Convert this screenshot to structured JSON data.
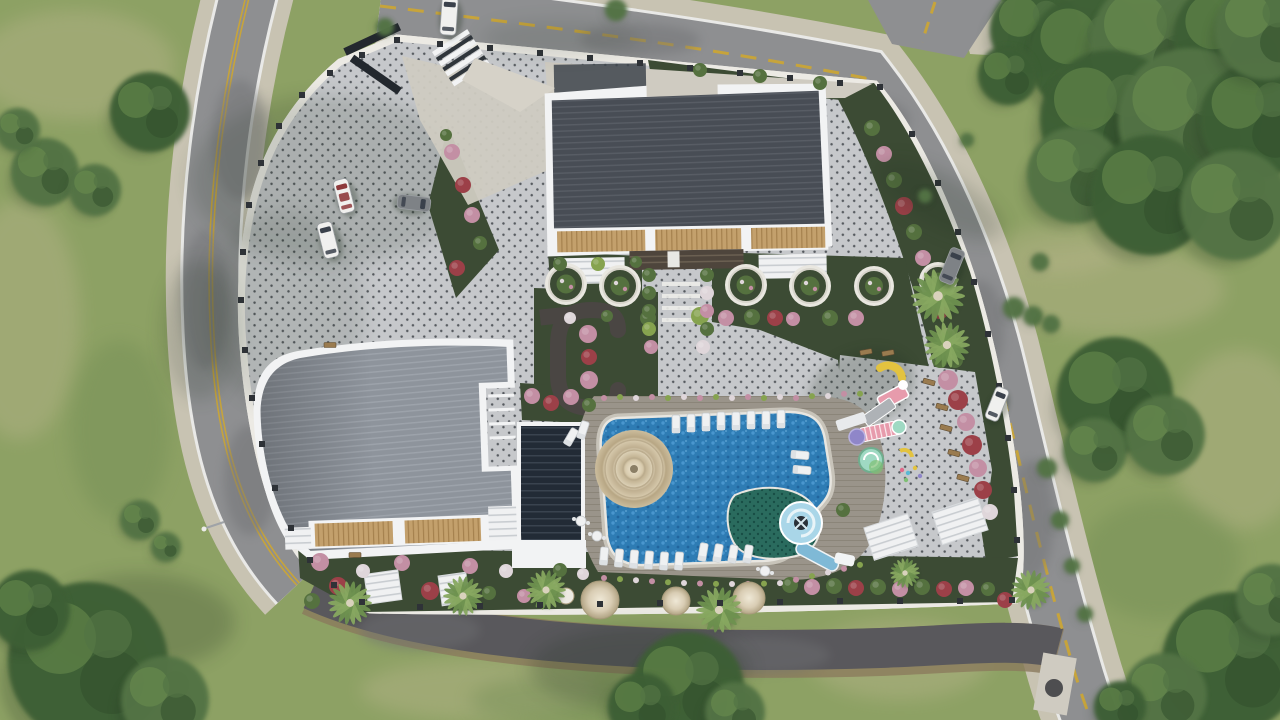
{
  "meta": {
    "type": "aerial-3d-architectural-render",
    "subject": "top-down site plan of a residential complex with two apartment blocks, pool and gardens",
    "view": "bird's-eye / plan view",
    "dimensions": "1280x720"
  },
  "palette": {
    "grass_base": "#8DA164",
    "grass_light": "#B6B489",
    "grass_dark": "#708B52",
    "tree_dark": "#3E5F35",
    "tree_mid": "#527345",
    "tree_light": "#6E914F",
    "road": "#8E8F91",
    "road_dark": "#59585C",
    "road_brown": "#8B7B5C",
    "road_edge": "#E9E9E7",
    "road_yellow": "#C7A43B",
    "sidewalk": "#C8C3B2",
    "curb": "#ECEAE4",
    "paving": "#C6C8CB",
    "paving_dot": "#42464C",
    "fence": "#2E3237",
    "roof_a": "#484D55",
    "roof_a_rib": "#585D65",
    "roof_b": "#8E949C",
    "roof_b_rib": "#9DA3AB",
    "trim": "#F2F3F4",
    "wood": "#C3A06C",
    "wood_rib": "#A5814E",
    "garden": "#3C4B34",
    "bush_green": "#55713F",
    "bush_lime": "#86A34F",
    "flower_pink": "#C38FA4",
    "flower_red": "#9C4048",
    "flower_white": "#DFD6DA",
    "deck": "#9A948A",
    "deck_rib": "#8B8579",
    "pool": "#2E7CB4",
    "pool_light": "#4E9BD2",
    "pool_deep": "#1F639B",
    "kids_pool": "#2A6B5E",
    "kids_dot": "#184E45",
    "slide": "#A9D6E8",
    "slide_deep": "#7FB9D6",
    "cone": "#D8CBB0",
    "cone_ring": "#BCAD8F",
    "dome": "#D9CDB4",
    "pergola_dark": "#222B36",
    "pergola_rib": "#39434F",
    "canopy": "#F0F1F2",
    "canopy_rib": "#C9CDD1",
    "path_dark": "#4A4643",
    "steps_brown": "#4E453C",
    "concrete": "#CFCBC1",
    "car_white": "#F0F0EE",
    "car_gray": "#7E8286",
    "car_red": "#8E3A3C",
    "glass": "#3A414B",
    "shadow": "#223022",
    "play_yellow": "#E3C33F",
    "play_pink": "#E79BAC",
    "play_mint": "#9FD9C3",
    "play_green": "#7FBF74",
    "play_purple": "#8F86C9",
    "play_gray": "#AEB2B6"
  },
  "scene": {
    "site": {
      "boundary": "fenced polygon bounded by curving asphalt roads on all sides",
      "paving": "light pavers with dark diamond dot grid",
      "entrance": "north gate with white stairs and ramp"
    },
    "buildings": [
      {
        "id": "block-a",
        "position": "top-center",
        "roof": "dark gray ribbed",
        "trim": "white",
        "balconies": "wood-slat"
      },
      {
        "id": "block-b",
        "position": "center-left",
        "roof": "light gray ribbed with curved corner",
        "trim": "white",
        "balconies": "wood-slat"
      }
    ],
    "amenities": {
      "pool": "free-form blue swimming pool with coping",
      "kids_pool": "dark teal tiled splash pool",
      "water_slide": "light blue spiral slide",
      "shade_cone": "beige conical canopy over pool corner",
      "sun_loungers": 22,
      "round_tables": 3,
      "playground": "colorful play structures on paved court",
      "white_pergolas": 4,
      "dark_pergola": 1,
      "garden_domes": 5,
      "circular_planters": 6,
      "walking_loop": "dark C-shaped garden path"
    },
    "vehicles": {
      "parking_lot": [
        "white convertible",
        "white van",
        "gray sedan"
      ],
      "street": [
        "white van at north gate",
        "gray car on east road",
        "white car on east road"
      ]
    },
    "vegetation": {
      "palm_trees": 8,
      "tree_clusters": "dense green canopies on surrounding lawn",
      "shrubs": "rows of green, lime, pink, red and white bushes"
    },
    "roads": {
      "markings": "yellow center lines and white edge lines",
      "sidewalks": "beige concrete bands"
    }
  }
}
